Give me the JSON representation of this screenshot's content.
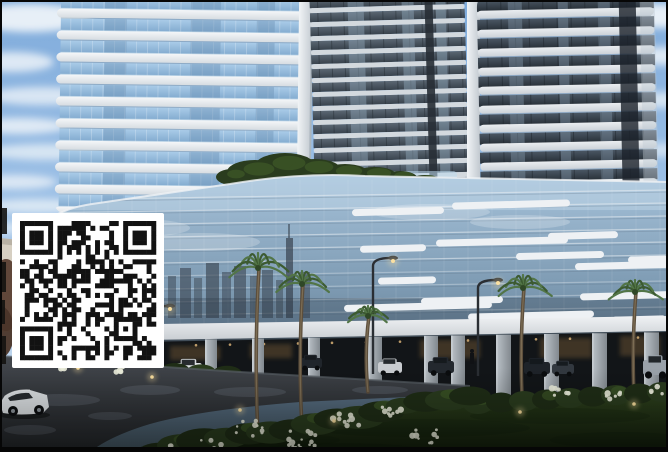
{
  "image": {
    "width": 668,
    "height": 452,
    "subject": "residential-towers-render-with-qr-watermark"
  },
  "qr": {
    "x": 12,
    "y": 213,
    "w": 152,
    "h": 155,
    "quiet": 8,
    "modules": 29,
    "seed": 1337,
    "dark": "#121212",
    "light": "#ffffff"
  },
  "scene": {
    "palette": {
      "sky_top": "#7fabdb",
      "sky_mid": "#a2c4e8",
      "sky_bottom": "#cfe0f1",
      "cloud": "#f2f6fa",
      "slab_top": "#f4f6f8",
      "slab_bot": "#d6dce1",
      "slab_shadow": "#93a5b3",
      "lt_glass_top": "#a9cbe8",
      "lt_glass_bot": "#7fa8cd",
      "lt_pane": "#6d92b6",
      "lt_lip": "#d6e7f2",
      "rtA_glass_top": "#5b6773",
      "rtA_glass_bot": "#39434d",
      "rtB_glass_top": "#4a5663",
      "rtB_glass_bot": "#272f37",
      "slabB_top": "#eaedf0",
      "slabB_bot": "#ccd2d8",
      "pier_top": "#f1f4f6",
      "pier_bot": "#c2c9d0",
      "pod1": "#a6c2da",
      "pod2": "#7e9bb3",
      "pod3": "#5a7187",
      "pod4": "#42545f",
      "mullion": "#e9eef2",
      "slash": "#eef1f4",
      "skyline_refl": "#38424e",
      "fascia_top": "#f0f2f4",
      "fascia_bot": "#c6cbd0",
      "colonnade": "#121518",
      "column_light": "#bcc3c9",
      "column_dark": "#82898f",
      "warm_light": "#d9b277",
      "warm_glow": "#6b5334",
      "road_top": "#43474d",
      "road_bot": "#222528",
      "road_sheen": "#8a92a0",
      "lawn_top": "#2e421d",
      "lawn_bot": "#131e0c",
      "bush_dark": "#1f2d16",
      "bush_mid": "#2a3c1e",
      "bush_light": "#3c5526",
      "flower": "#e9ebda",
      "trunk": "#5c4e3c",
      "trunk_hi": "#8a7a5e",
      "frond": "#3c5a31",
      "frond_hi": "#527547",
      "lamp_pole": "#2a2e33",
      "lamp_glow": "#ffe3a1",
      "wall": "#d6cfc2",
      "red_tree": "#5a3f33",
      "distant_city": "#8fa3b5",
      "car_window": "#14181c",
      "frame": "#060606",
      "white_car": "#dde1e4"
    },
    "towers": {
      "left": {
        "x": 56,
        "w": 250,
        "gx": 60,
        "gw": 242,
        "floors": 11,
        "step": 22,
        "y0": -12,
        "slab_h": 9,
        "glass_h": 13,
        "pier_x": 298,
        "pier_w": 14,
        "bottom": 214
      },
      "a": {
        "x": 312,
        "w": 155,
        "floors": 15,
        "step": 14,
        "y0": -8,
        "slab_h": 5,
        "glass_h": 9,
        "recess_x": 427,
        "recess_w": 8,
        "bottom": 196,
        "pier_x": 467,
        "pier_w": 13
      },
      "b": {
        "x": 479,
        "w": 177,
        "floors": 13,
        "step": 19,
        "y0": -10,
        "slab_h": 8,
        "glass_h": 11,
        "recess_x": 621,
        "recess_w": 17,
        "sliver_x": 642,
        "bottom": 236
      }
    },
    "clouds": [
      [
        30,
        18,
        62,
        14,
        0.9
      ],
      [
        12,
        62,
        42,
        10,
        0.8
      ],
      [
        42,
        96,
        56,
        9,
        0.75
      ],
      [
        20,
        126,
        48,
        8,
        0.8
      ],
      [
        46,
        152,
        60,
        8,
        0.7
      ],
      [
        15,
        182,
        42,
        7,
        0.75
      ],
      [
        36,
        206,
        52,
        7,
        0.7
      ],
      [
        8,
        228,
        30,
        6,
        0.6
      ],
      [
        660,
        16,
        46,
        12,
        0.9
      ],
      [
        665,
        56,
        36,
        9,
        0.8
      ],
      [
        662,
        100,
        30,
        8,
        0.7
      ],
      [
        660,
        150,
        28,
        7,
        0.6
      ],
      [
        664,
        205,
        26,
        7,
        0.5
      ]
    ],
    "distant_blocks": [
      [
        652,
        248,
        16,
        66
      ],
      [
        658,
        262,
        10,
        52
      ]
    ],
    "hedge": [
      [
        232,
        177,
        16,
        8
      ],
      [
        255,
        172,
        28,
        12
      ],
      [
        285,
        166,
        30,
        13
      ],
      [
        315,
        170,
        26,
        11
      ],
      [
        345,
        174,
        24,
        10
      ],
      [
        375,
        176,
        22,
        9
      ],
      [
        400,
        179,
        18,
        8
      ],
      [
        425,
        182,
        16,
        7
      ]
    ],
    "slashes": [
      [
        352,
        208,
        92
      ],
      [
        452,
        201,
        118
      ],
      [
        360,
        245,
        66
      ],
      [
        436,
        238,
        132
      ],
      [
        516,
        252,
        88
      ],
      [
        378,
        277,
        58
      ],
      [
        421,
        297,
        82
      ],
      [
        344,
        303,
        148
      ],
      [
        468,
        312,
        126
      ],
      [
        575,
        262,
        96
      ],
      [
        628,
        256,
        40
      ],
      [
        580,
        292,
        108
      ],
      [
        612,
        316,
        54
      ],
      [
        548,
        232,
        70
      ]
    ],
    "skyline": {
      "baseY": 318,
      "bars": [
        [
          168,
          8,
          42,
          0.5
        ],
        [
          180,
          11,
          50,
          0.58
        ],
        [
          194,
          8,
          40,
          0.48
        ],
        [
          206,
          13,
          55,
          0.62
        ],
        [
          222,
          9,
          46,
          0.52
        ],
        [
          234,
          12,
          52,
          0.58
        ],
        [
          250,
          8,
          42,
          0.48
        ],
        [
          262,
          11,
          48,
          0.56
        ],
        [
          276,
          7,
          38,
          0.48
        ],
        [
          300,
          10,
          46,
          0.52
        ]
      ],
      "spire": [
        286,
        238,
        7,
        80
      ]
    },
    "columns": [
      [
        60,
        11
      ],
      [
        105,
        11
      ],
      [
        152,
        11
      ],
      [
        205,
        12
      ],
      [
        252,
        12
      ],
      [
        308,
        12
      ],
      [
        368,
        14
      ],
      [
        424,
        14
      ],
      [
        451,
        14
      ],
      [
        496,
        15
      ],
      [
        544,
        15
      ],
      [
        592,
        15
      ],
      [
        644,
        15
      ]
    ],
    "interior_glows": [
      [
        80,
        348,
        40,
        14
      ],
      [
        170,
        346,
        50,
        14
      ],
      [
        250,
        344,
        42,
        14
      ],
      [
        420,
        340,
        60,
        18
      ],
      [
        540,
        338,
        52,
        20
      ],
      [
        620,
        336,
        40,
        20
      ]
    ],
    "cars": [
      {
        "x": 95,
        "y": 358,
        "w": 22,
        "h": 10,
        "c": "#2a2f35"
      },
      {
        "x": 176,
        "y": 363,
        "w": 26,
        "h": 13,
        "c": "#dde1e4"
      },
      {
        "x": 300,
        "y": 358,
        "w": 22,
        "h": 10,
        "c": "#20252b"
      },
      {
        "x": 378,
        "y": 362,
        "w": 24,
        "h": 11,
        "c": "#c9ccd0"
      },
      {
        "x": 428,
        "y": 361,
        "w": 26,
        "h": 12,
        "c": "#23282e"
      },
      {
        "x": 524,
        "y": 362,
        "w": 26,
        "h": 12,
        "c": "#1e2329"
      },
      {
        "x": 552,
        "y": 364,
        "w": 22,
        "h": 10,
        "c": "#32383f"
      },
      {
        "x": 643,
        "y": 360,
        "w": 25,
        "h": 15,
        "c": "#9aa2aa"
      }
    ],
    "person": [
      470,
      349,
      4,
      15
    ],
    "palms": [
      [
        112,
        246,
        356,
        19
      ],
      [
        258,
        268,
        436,
        30
      ],
      [
        302,
        284,
        428,
        26
      ],
      [
        368,
        316,
        392,
        20
      ],
      [
        523,
        288,
        416,
        26
      ],
      [
        635,
        292,
        414,
        24
      ]
    ],
    "lamps": [
      [
        373,
        258,
        374,
        1
      ],
      [
        478,
        280,
        376,
        1
      ],
      [
        150,
        306,
        366,
        1
      ]
    ],
    "path_lights": [
      [
        78,
        368
      ],
      [
        152,
        377
      ],
      [
        240,
        410
      ],
      [
        334,
        421
      ],
      [
        520,
        412
      ],
      [
        634,
        404
      ]
    ],
    "flowers": [
      [
        252,
        428,
        16,
        10
      ],
      [
        300,
        440,
        18,
        12
      ],
      [
        345,
        420,
        14,
        9
      ],
      [
        390,
        412,
        12,
        8
      ],
      [
        425,
        436,
        14,
        9
      ],
      [
        210,
        446,
        14,
        8
      ],
      [
        170,
        450,
        12,
        7
      ],
      [
        560,
        392,
        10,
        7
      ],
      [
        612,
        396,
        9,
        6
      ],
      [
        655,
        390,
        8,
        5
      ],
      [
        60,
        366,
        6,
        4
      ],
      [
        120,
        369,
        6,
        4
      ],
      [
        305,
        452,
        16,
        8
      ]
    ],
    "signboard": [
      44,
      372,
      28,
      18
    ],
    "edge_blobs": [
      [
        0,
        208,
        7,
        26
      ],
      [
        0,
        262,
        6,
        30
      ],
      [
        0,
        300,
        5,
        24
      ],
      [
        0,
        336,
        6,
        28
      ]
    ]
  }
}
